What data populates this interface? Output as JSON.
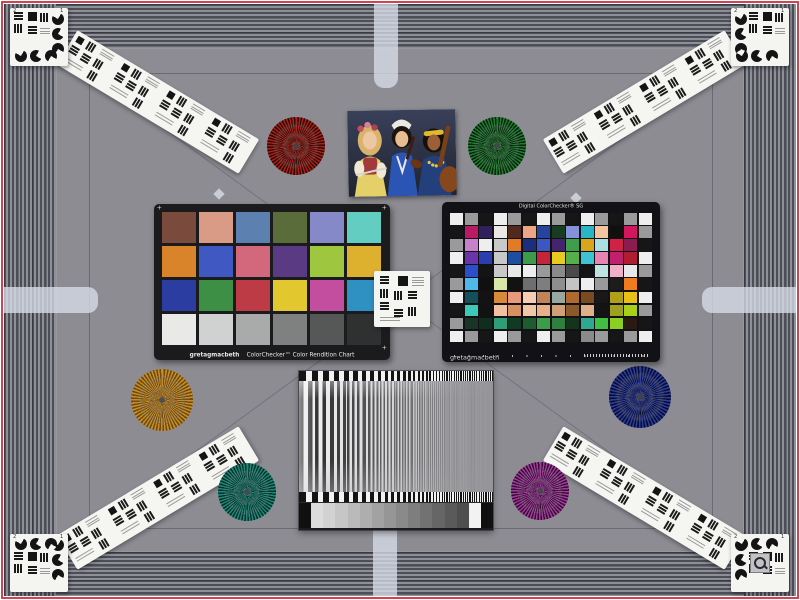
{
  "scene": {
    "alt": "Camera lab test scene with color and resolution targets"
  },
  "colors": {
    "border_red": "#cf4450",
    "field_gray": "#8c8c92",
    "stripe_dark": "#4e4e58",
    "stripe_light": "#8e9098",
    "tab_light": "#d7dce8",
    "card_white": "#f4f4f0",
    "chart_black": "#1b1b1d"
  },
  "colorchecker": {
    "brand": "gretagmacbeth",
    "title": "ColorChecker™ Color Rendition Chart",
    "patches": [
      [
        "#7a4b3c",
        "#d99b85",
        "#5c80b0",
        "#5a6c3a",
        "#8589c8",
        "#63cdc1"
      ],
      [
        "#d9842b",
        "#4059c2",
        "#d3687c",
        "#5b3a84",
        "#9ec63e",
        "#ddb02e"
      ],
      [
        "#2b3da0",
        "#3d8f45",
        "#bc3b44",
        "#e3c72e",
        "#c34ea0",
        "#2f90c2"
      ],
      [
        "#e9e9e7",
        "#d0d1d1",
        "#a9abab",
        "#7f8181",
        "#565858",
        "#2f3030"
      ]
    ]
  },
  "sg": {
    "title": "Digital ColorChecker® SG",
    "brand": "gretagmacbeth",
    "patches": [
      [
        "#eeeeee",
        "#9a9a9a",
        "#161616",
        "#eeeeee",
        "#9a9a9a",
        "#161616",
        "#eeeeee",
        "#9a9a9a",
        "#161616",
        "#eeeeee",
        "#9a9a9a",
        "#161616",
        "#9a9a9a",
        "#eeeeee"
      ],
      [
        "#161616",
        "#b91a63",
        "#32205a",
        "#ece8e6",
        "#51291d",
        "#eda586",
        "#27449c",
        "#173c20",
        "#8492dc",
        "#2ab5c4",
        "#f4c49e",
        "#101010",
        "#d2175f",
        "#9a9a9a"
      ],
      [
        "#9a9a9a",
        "#c681c9",
        "#eeeeee",
        "#c9c9c9",
        "#e17b26",
        "#1b2f7d",
        "#3d57c2",
        "#45246e",
        "#3f9e4c",
        "#d8a61c",
        "#a8e0e4",
        "#cf2244",
        "#8c1c4f",
        "#161616"
      ],
      [
        "#eeeeee",
        "#6a35a8",
        "#2b3eb0",
        "#c8c8c8",
        "#1e4e9e",
        "#3d9c4a",
        "#c22638",
        "#e8cb1e",
        "#55b04a",
        "#3ec2d4",
        "#e883b2",
        "#c2206e",
        "#b01c30",
        "#eeeeee"
      ],
      [
        "#161616",
        "#2d4ecc",
        "#141414",
        "#c8c8c8",
        "#e8e8e8",
        "#eeeeee",
        "#9a9a9a",
        "#8a8a8a",
        "#4a4a4a",
        "#141414",
        "#bfe3e0",
        "#f0b0c8",
        "#e8e8e8",
        "#9a9a9a"
      ],
      [
        "#9a9a9a",
        "#4fb8e8",
        "#101010",
        "#d8e8a8",
        "#121212",
        "#6e6e6e",
        "#7e7e7e",
        "#8e8e8e",
        "#c4c4c4",
        "#eeeeee",
        "#9a9a9a",
        "#1c1c1c",
        "#ee7c1e",
        "#161616"
      ],
      [
        "#eeeeee",
        "#14505a",
        "#131313",
        "#d88a38",
        "#e89a7a",
        "#f4cdb4",
        "#c08458",
        "#98a8a0",
        "#b06a30",
        "#7a4a20",
        "#181818",
        "#b0a018",
        "#e8c018",
        "#eeeeee"
      ],
      [
        "#161616",
        "#3ec8b8",
        "#121212",
        "#f0c0a0",
        "#d89060",
        "#f0c8a8",
        "#e8b088",
        "#d0a078",
        "#8a5a28",
        "#e0b088",
        "#141414",
        "#a0a020",
        "#a8d018",
        "#9a9a9a"
      ],
      [
        "#9a9a9a",
        "#1a3428",
        "#0f2e1e",
        "#2e9e78",
        "#123a22",
        "#1e5c30",
        "#3a9e48",
        "#2e8040",
        "#16341c",
        "#2ea890",
        "#40c040",
        "#8ad020",
        "#2a1a10",
        "#161616"
      ],
      [
        "#eeeeee",
        "#9a9a9a",
        "#161616",
        "#eeeeee",
        "#9a9a9a",
        "#161616",
        "#eeeeee",
        "#9a9a9a",
        "#161616",
        "#8a8a8a",
        "#9a9a9a",
        "#161616",
        "#9a9a9a",
        "#eeeeee"
      ]
    ]
  },
  "stars": [
    {
      "id": "red",
      "color": "#a82018",
      "dark": "#2e0a06"
    },
    {
      "id": "green",
      "color": "#1f7c30",
      "dark": "#07230c"
    },
    {
      "id": "gold",
      "color": "#c68c28",
      "dark": "#6e4a10"
    },
    {
      "id": "blue",
      "color": "#2c3c9c",
      "dark": "#090e2e"
    },
    {
      "id": "teal",
      "color": "#1f8878",
      "dark": "#06302a"
    },
    {
      "id": "magenta",
      "color": "#a23a9c",
      "dark": "#360e34"
    }
  ],
  "gray_wedge": {
    "steps": [
      "#101010",
      "#dcdcdc",
      "#d2d2d2",
      "#c6c6c6",
      "#bababa",
      "#aeaeae",
      "#a2a2a2",
      "#969696",
      "#8a8a8a",
      "#7e7e7e",
      "#727272",
      "#666666",
      "#5a5a5a",
      "#4e4e4e",
      "#f2f2f2",
      "#101010"
    ]
  },
  "corner_digits": [
    "2",
    "1"
  ],
  "photo": {
    "alt": "Three musicians with flute, violin and lute"
  }
}
